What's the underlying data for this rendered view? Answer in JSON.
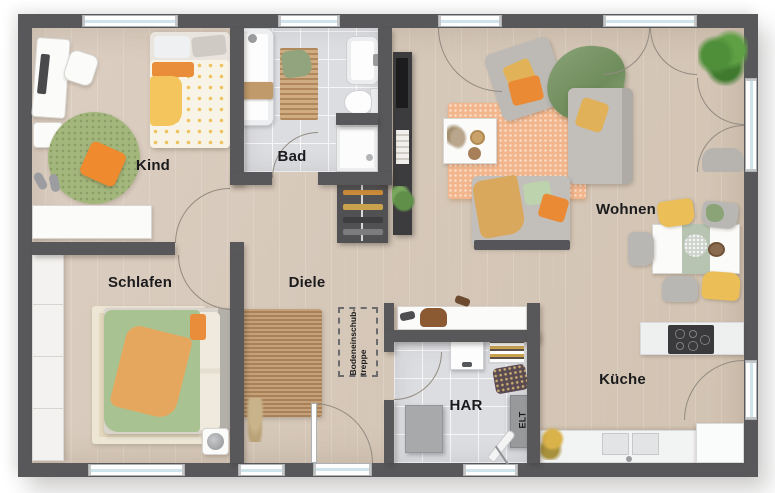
{
  "plan": {
    "rooms": {
      "kind": {
        "label": "Kind"
      },
      "bad": {
        "label": "Bad"
      },
      "wohnen": {
        "label": "Wohnen"
      },
      "schlafen": {
        "label": "Schlafen"
      },
      "diele": {
        "label": "Diele"
      },
      "har": {
        "label": "HAR"
      },
      "kueche": {
        "label": "Küche"
      },
      "elt": {
        "label": "ELT"
      }
    },
    "annotations": {
      "attic_stairs": {
        "line1": "Bodeneinschub-",
        "line2": "treppe"
      }
    },
    "colors": {
      "wall": "#58585b",
      "wood_floor": "#d6c9ba",
      "tile_floor": "#dcdde0",
      "accent_orange": "#ec8b35",
      "accent_yellow": "#e9bd58",
      "accent_green": "#a3b77d",
      "rug_orange": "#f3b68c",
      "rug_jute": "#bd9468"
    }
  }
}
